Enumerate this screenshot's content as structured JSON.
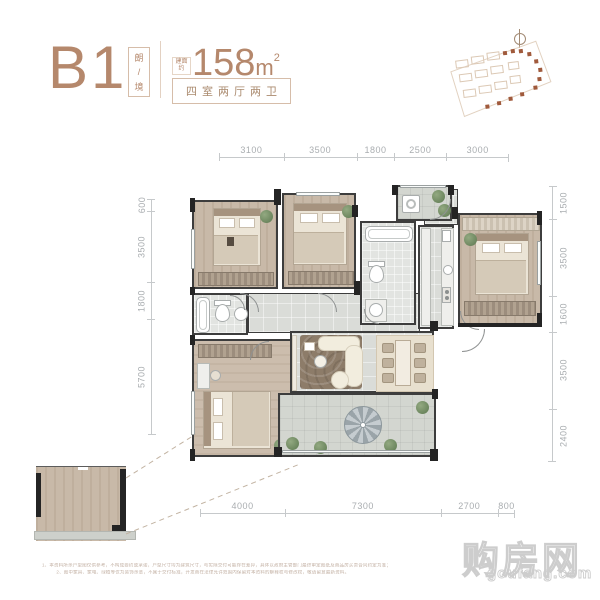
{
  "header": {
    "code": "B1",
    "name_top": "朗",
    "name_sep": "/",
    "name_bottom": "境",
    "area_prefix_top": "建面",
    "area_prefix_bottom": "约",
    "area_value": "158",
    "area_unit": "m",
    "area_exponent": "2",
    "layout_label": "四室两厅两卫"
  },
  "dimensions": {
    "top": [
      "3100",
      "3500",
      "1800",
      "2500",
      "3000"
    ],
    "left": [
      "600",
      "3500",
      "1800",
      "5700"
    ],
    "right": [
      "1500",
      "3500",
      "1600",
      "3500",
      "2400"
    ],
    "bottom": [
      "4000",
      "7300",
      "2700",
      "800"
    ]
  },
  "watermark": {
    "cn": "购房网",
    "en": "goufang.com"
  },
  "fine_print": {
    "line1": "1、本资料所示户型图仅供参考，不构成要约或承诺，户型尺寸均为建筑尺寸，与实际交付可能存在差异，具体以政府主管部门最终审定图纸及商品房买卖合同约定为准；",
    "line2": "2、图中家具、家电、绿植等仅为装饰示意，不属于交付标准，开发商在法律允许范围内保留对本资料的解释权与修改权，敬请留意最新资料。"
  },
  "icons": {
    "compass": "compass-north-icon",
    "key_plan": "site-key-plan"
  },
  "colors": {
    "accent": "#b5886c",
    "wall": "#3d3d3d",
    "dimension_text": "#a9adb0",
    "watermark": "#cdcdcd",
    "wood_floor": "#c8b9a8",
    "tile_floor": "#dadcd8"
  }
}
